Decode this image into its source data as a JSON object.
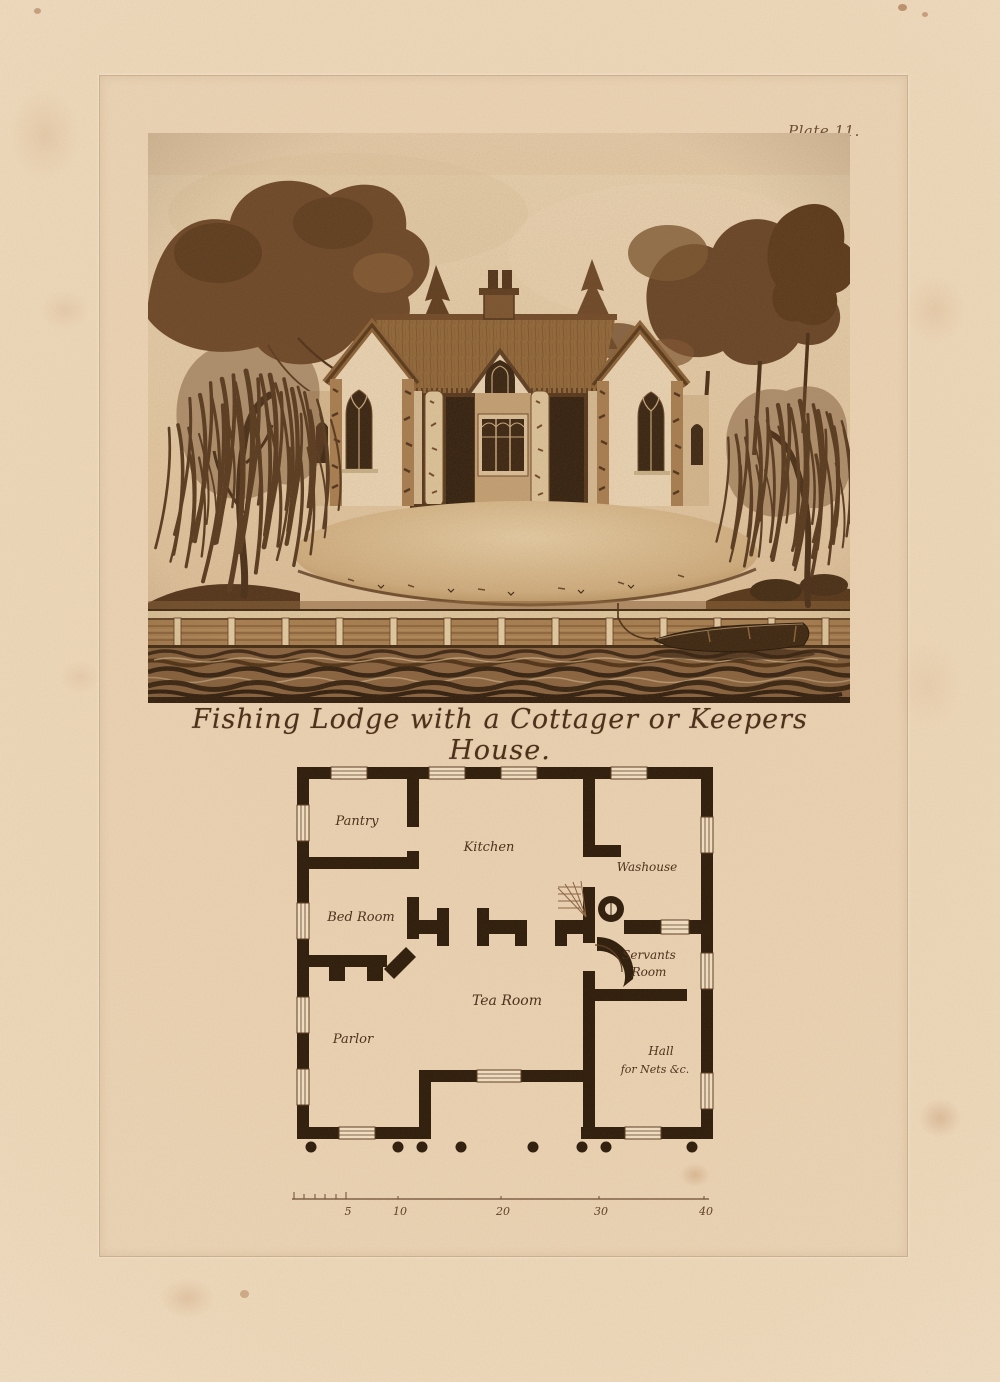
{
  "page": {
    "plate_label": "Plate 11.",
    "title": "Fishing Lodge with a Cottager or Keepers House."
  },
  "floor_plan": {
    "rooms": {
      "pantry": "Pantry",
      "kitchen": "Kitchen",
      "washouse": "Washouse",
      "bed_room": "Bed Room",
      "servants_line1": "Servants",
      "servants_line2": "Room",
      "tea_room": "Tea Room",
      "parlor": "Parlor",
      "hall_line1": "Hall",
      "hall_line2": "for Nets &c."
    },
    "scale_ticks": {
      "t5": "5",
      "t10": "10",
      "t20": "20",
      "t30": "30",
      "t40": "40"
    }
  },
  "colors": {
    "paper": "#eed9bc",
    "ink_dark": "#33200f",
    "ink_mid": "#7a5530",
    "wall": "#2f1d0d"
  }
}
